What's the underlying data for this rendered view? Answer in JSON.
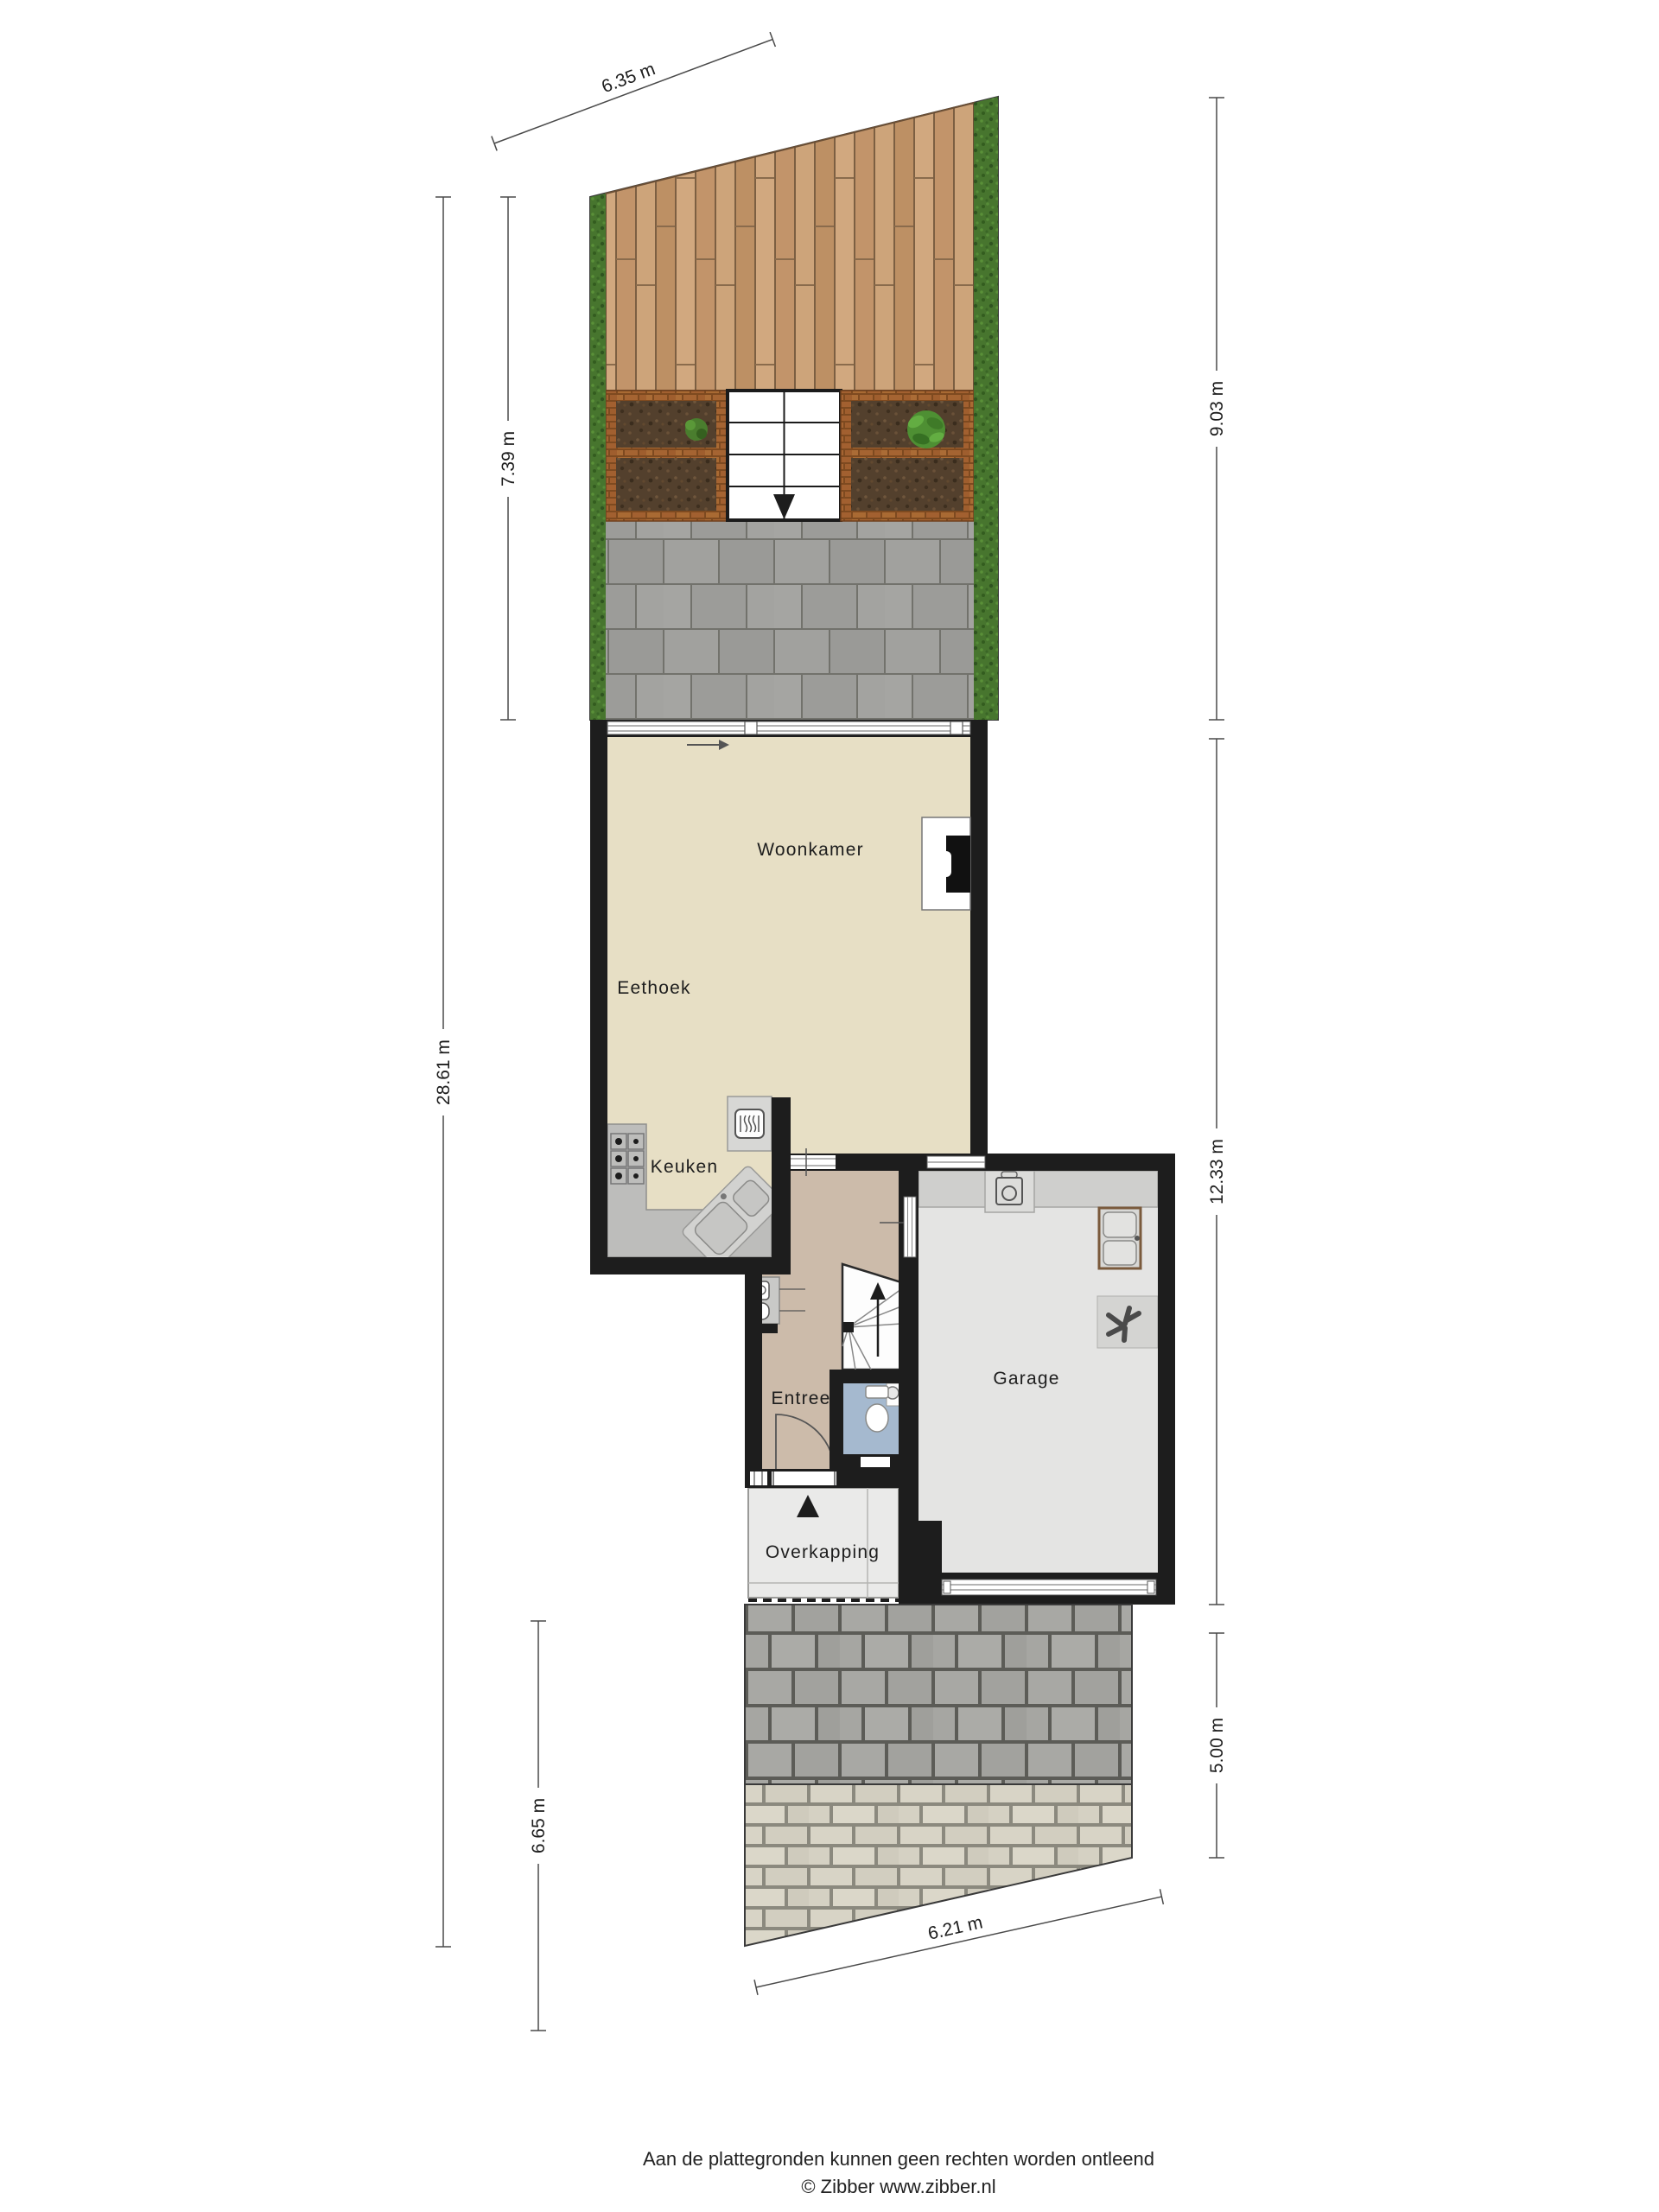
{
  "plan": {
    "title": "Begane grond met tuin en oprit",
    "rooms": [
      {
        "id": "woonkamer",
        "label": "Woonkamer"
      },
      {
        "id": "eethoek",
        "label": "Eethoek"
      },
      {
        "id": "keuken",
        "label": "Keuken"
      },
      {
        "id": "entree",
        "label": "Entree"
      },
      {
        "id": "garage",
        "label": "Garage"
      },
      {
        "id": "overkapping",
        "label": "Overkapping"
      }
    ],
    "dimensions": {
      "garden_width_top": "6.35 m",
      "garden_depth_left": "7.39 m",
      "garden_depth_right": "9.03 m",
      "plot_depth_left": "28.61 m",
      "house_depth_right": "12.33 m",
      "driveway_depth_left": "6.65 m",
      "driveway_depth_right": "5.00 m",
      "driveway_width_bottom": "6.21 m"
    },
    "icons": {
      "garden_stairs_direction": "down-arrow",
      "entrance_direction": "up-arrow",
      "stairs_up_direction": "up-arrow",
      "sliding_door_direction": "right-arrow",
      "hob": "6-burner-hob",
      "oven": "oven",
      "sink": "double-sink",
      "washing_machine": "washing-machine",
      "garage_sink": "double-basin-unit",
      "ventilation_fan": "fan",
      "toilet": "toilet",
      "hand_basin": "hand-basin",
      "meter_cupboard": "meter-cupboard"
    },
    "colors": {
      "wall": "#1d1d1d",
      "living_floor": "#e7dfc5",
      "hall_floor": "#ccbbaa",
      "toilet_floor": "#a5b9cf",
      "garage_floor": "#e4e4e3",
      "counter": "#bdbdbb",
      "deck_wood": "#c59a6e",
      "hedge": "#47752e",
      "soil": "#53402d",
      "planter_brick": "#a2602e",
      "patio_paver": "#9e9e9b",
      "driveway_paver": "#a7a7a3",
      "driveway_brick": "#d6d2c4",
      "dimension_line": "#4a4a4a"
    }
  },
  "footer": {
    "disclaimer": "Aan de plattegronden kunnen geen rechten worden ontleend",
    "credit": "© Zibber www.zibber.nl"
  }
}
